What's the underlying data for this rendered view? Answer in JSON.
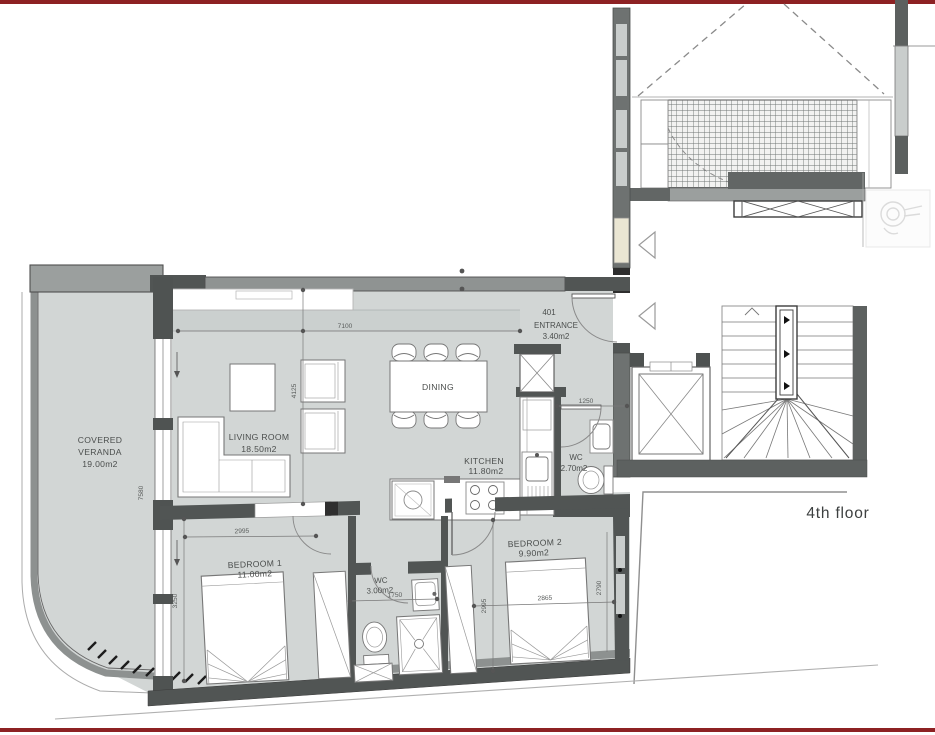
{
  "page": {
    "floor_label": "4th floor"
  },
  "rooms": {
    "veranda": {
      "name_line1": "COVERED",
      "name_line2": "VERANDA",
      "area": "19.00m2"
    },
    "living_room": {
      "name": "LIVING ROOM",
      "area": "18.50m2"
    },
    "dining": {
      "name": "DINING"
    },
    "kitchen": {
      "name": "KITCHEN",
      "area": "11.80m2"
    },
    "entrance": {
      "unit_number": "401",
      "name": "ENTRANCE",
      "area": "3.40m2"
    },
    "wc_main": {
      "name": "WC",
      "area": "2.70m2"
    },
    "bedroom1": {
      "name": "BEDROOM 1",
      "area": "11.00m2"
    },
    "wc_bedrooms": {
      "name": "WC",
      "area": "3.00m2"
    },
    "bedroom2": {
      "name": "BEDROOM 2",
      "area": "9.90m2"
    }
  },
  "dimensions": {
    "living_width": "7100",
    "living_depth": "4125",
    "wc_main_width": "1250",
    "veranda_depth": "7580",
    "veranda_side": "3250",
    "bedroom1_width": "2995",
    "wc_bedrooms_width": "1750",
    "bedroom2_left": "2995",
    "bedroom2_width": "2865",
    "bedroom2_depth": "2790"
  },
  "colors": {
    "accent_red": "#8d2123",
    "wall_dark": "#515554",
    "wall_medium": "#8f9392",
    "room_fill": "#d2d6d5",
    "window_fill": "#c9cdcc",
    "door_cream": "#eae6d3"
  }
}
